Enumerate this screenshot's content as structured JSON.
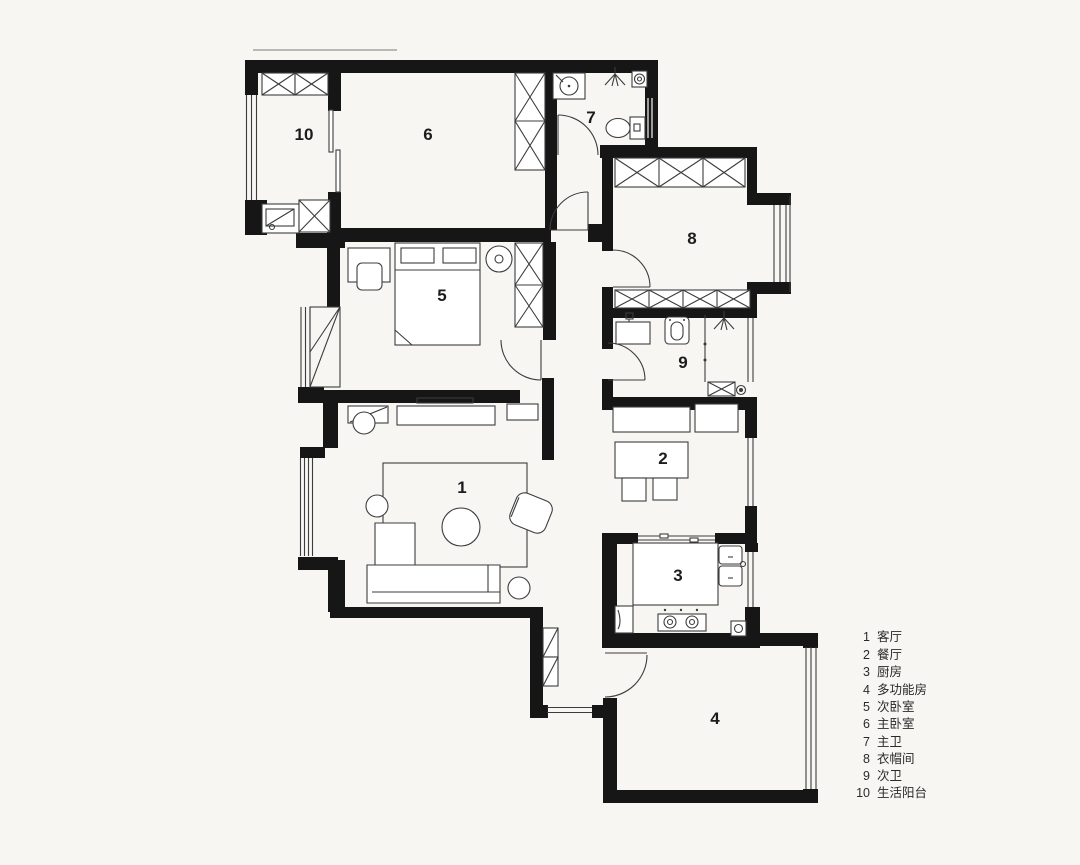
{
  "title": "户型平面图",
  "rooms": [
    {
      "num": "1",
      "name": "客厅"
    },
    {
      "num": "2",
      "name": "餐厅"
    },
    {
      "num": "3",
      "name": "厨房"
    },
    {
      "num": "4",
      "name": "多功能房"
    },
    {
      "num": "5",
      "name": "次卧室"
    },
    {
      "num": "6",
      "name": "主卧室"
    },
    {
      "num": "7",
      "name": "主卫"
    },
    {
      "num": "8",
      "name": "衣帽间"
    },
    {
      "num": "9",
      "name": "次卫"
    },
    {
      "num": "10",
      "name": "生活阳台"
    }
  ]
}
